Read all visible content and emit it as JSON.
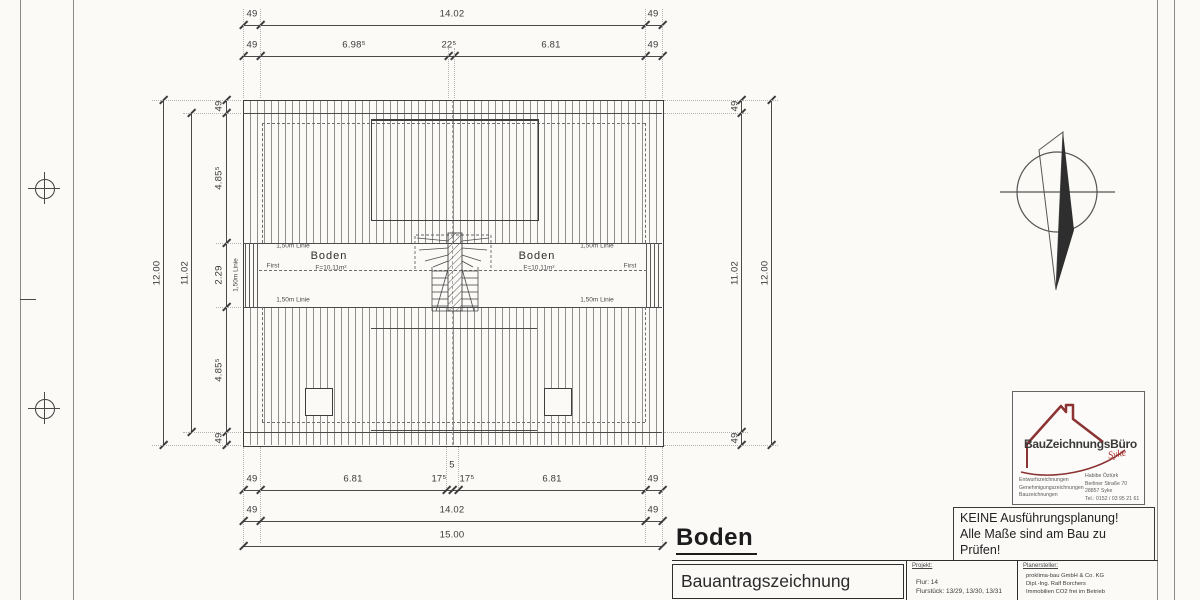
{
  "title": "Boden",
  "plan": {
    "room": "Boden",
    "area": "F=10.11m²",
    "first": "First",
    "label_150": "1,50m Linie"
  },
  "dimensions": {
    "top_row1": [
      "49",
      "14.02",
      "49"
    ],
    "top_row2": [
      "49",
      "6.98⁵",
      "22⁵",
      "6.81",
      "49"
    ],
    "left_outer": "12.00",
    "left_inner": "11.02",
    "left_chain": [
      "49",
      "4.85⁵",
      "2.29",
      "4.85⁵",
      "49"
    ],
    "left_line150": "1,50m Linie",
    "right_chain": [
      "49",
      "11.02",
      "49"
    ],
    "right_outer": "12.00",
    "bottom_row1": [
      "49",
      "6.81",
      "17⁵",
      "5",
      "17⁵",
      "6.81",
      "49"
    ],
    "bottom_row2": [
      "49",
      "14.02",
      "49"
    ],
    "bottom_total": "15.00"
  },
  "notice": {
    "line1": "KEINE Ausführungsplanung!",
    "line2": "Alle Maße sind am Bau zu Prüfen!"
  },
  "logo": {
    "name_main": "BauZeichnungsBüro",
    "name_sub": "Syke",
    "services": [
      "Entwurfszeichnungen",
      "Genehmigungszeichnungen",
      "Bauzeichnungen"
    ],
    "contact": [
      "Habibe Öztürk",
      "Berliner Straße 70",
      "28857 Syke",
      "Tel.: 0152 / 03 95 21 61"
    ]
  },
  "title_block": {
    "drawing_type": "Bauantragszeichnung",
    "project_header": "Projekt:",
    "project_lines": [
      "Flur: 14",
      "Flurstück: 13/29, 13/30, 13/31"
    ],
    "author_header": "Planersteller:",
    "author_lines": [
      "proklima-bau GmbH & Co. KG",
      "Dipl.-Ing. Ralf Borchers",
      "Immobilien CO2 frei im Betrieb"
    ]
  },
  "icons": {
    "north_arrow": "compass-north-arrow",
    "registration_mark": "circle-crosshair"
  }
}
